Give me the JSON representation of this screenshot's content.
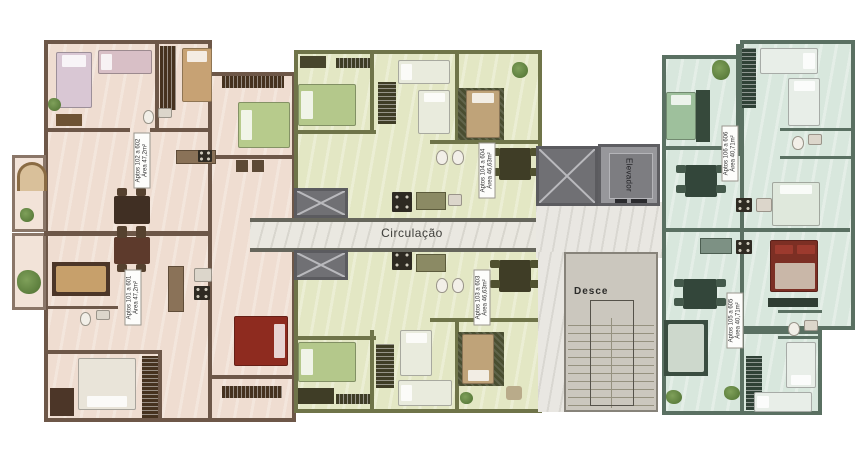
{
  "corridor": {
    "label": "Circulação"
  },
  "elevator": {
    "label": "Elevador"
  },
  "stairs": {
    "label": "Desce"
  },
  "units": [
    {
      "id": "pink-top",
      "line1": "Aptos 102 a 602",
      "line2": "Área 47,2m²"
    },
    {
      "id": "pink-bottom",
      "line1": "Aptos 101 a 601",
      "line2": "Área 47,2m²"
    },
    {
      "id": "green-top",
      "line1": "Aptos 104 a 604",
      "line2": "Área 46,63m²"
    },
    {
      "id": "green-bottom",
      "line1": "Aptos 103 a 603",
      "line2": "Área 46,63m²"
    },
    {
      "id": "teal-top",
      "line1": "Aptos 106 a 606",
      "line2": "Área 40,71m²"
    },
    {
      "id": "teal-bottom",
      "line1": "Aptos 105 a 605",
      "line2": "Área 40,71m²"
    }
  ],
  "palette": {
    "pink_floor": "#efddd1",
    "green_floor": "#e3e7c4",
    "teal_floor": "#d8e7dd",
    "corridor_floor": "#eae8e1",
    "wall_brown": "#6d5748",
    "wall_olive": "#6f7449",
    "wall_teal": "#5a7062",
    "shaft_gray": "#707074",
    "stairs_gray": "#cbc7be",
    "red_bed": "#8e2b1f",
    "dark_red_bed": "#7c2f24",
    "green_bed": "#b4c88b"
  }
}
